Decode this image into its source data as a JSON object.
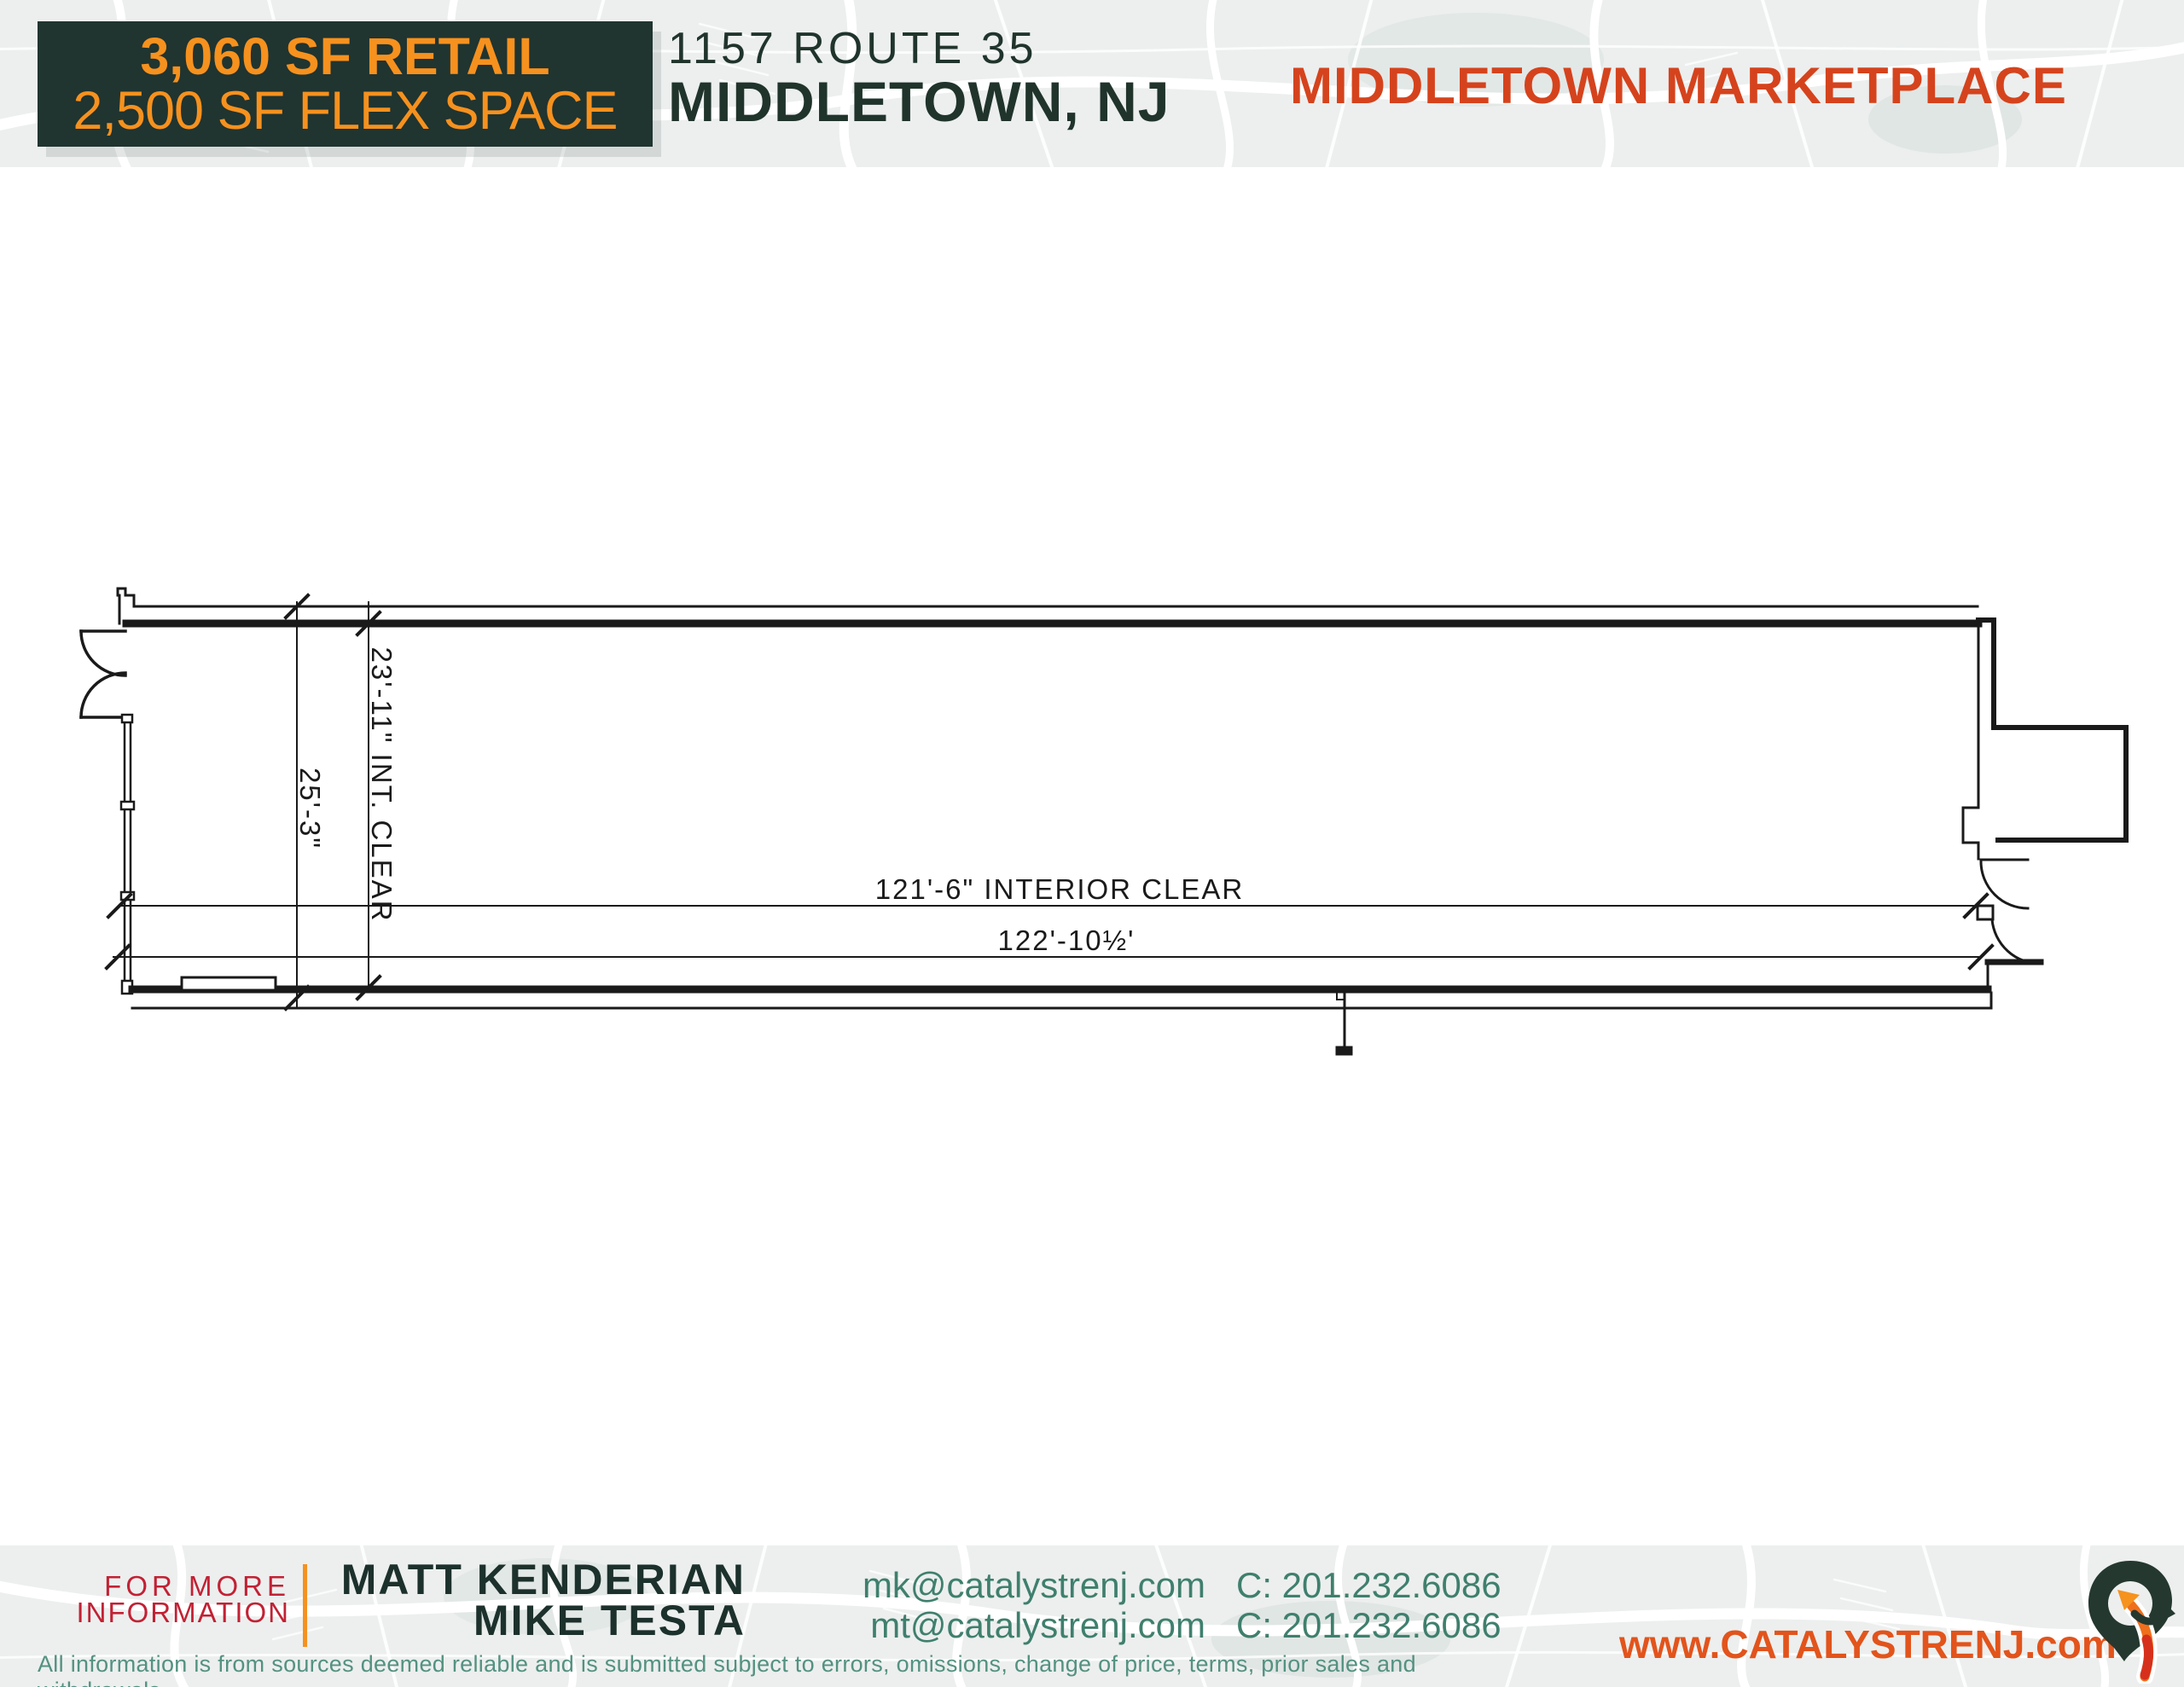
{
  "header": {
    "badge": {
      "line1": "3,060 SF RETAIL",
      "line2": "2,500 SF FLEX SPACE"
    },
    "address": {
      "line1": "1157 ROUTE 35",
      "line2": "MIDDLETOWN, NJ"
    },
    "property_name": "MIDDLETOWN MARKETPLACE"
  },
  "floor_plan": {
    "dim_vertical_overall": "25'-3\"",
    "dim_vertical_interior": "23'-11\" INT. CLEAR",
    "dim_horizontal_interior": "121'-6\" INTERIOR CLEAR",
    "dim_horizontal_overall": "122'-10½'"
  },
  "footer": {
    "for_more": {
      "line1": "FOR MORE",
      "line2": "INFORMATION"
    },
    "contacts": [
      {
        "name": "MATT KENDERIAN",
        "email": "mk@catalystrenj.com",
        "phone": "C: 201.232.6086"
      },
      {
        "name": "MIKE TESTA",
        "email": "mt@catalystrenj.com",
        "phone": "C: 201.232.6086"
      }
    ],
    "disclaimer": "All information is from sources deemed reliable and is submitted subject to errors, omissions, change of price, terms, prior sales and withdrawals.",
    "website": "www.CATALYSTRENJ.com",
    "logo_icon": "catalyst-pin-arrow-icon"
  },
  "colors": {
    "badge_background": "#203430",
    "badge_text": "#f6911e",
    "property_name": "#d5431d",
    "headline_dark": "#20342c",
    "for_more_red": "#c22134",
    "contact_teal": "#3f7f6d",
    "disclaimer_teal": "#549181",
    "website_orange": "#e2541c",
    "map_band_background": "#ecefee",
    "plan_linework": "#1a1a1a"
  }
}
